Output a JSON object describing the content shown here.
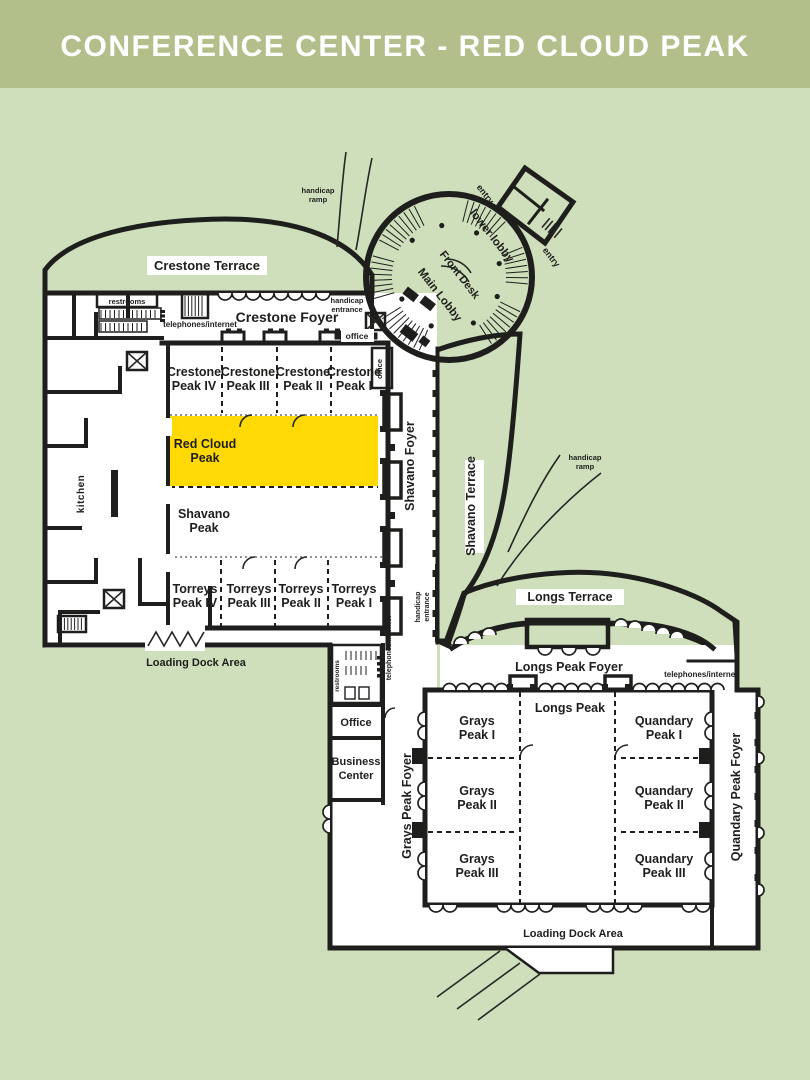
{
  "title": {
    "text": "CONFERENCE CENTER - RED CLOUD PEAK"
  },
  "colors": {
    "header_bg": "#b2bf8b",
    "page_bg": "#cfdfbc",
    "highlight": "#ffd903",
    "highlight_text": "#c7ae4e",
    "wall": "#1e1e1c",
    "terrace_fill": "#f3f2ec",
    "hatch_line": "#c2c2b8"
  },
  "lobby": {
    "lower_lobby": "lower lobby",
    "front_desk": "Front Desk",
    "main_lobby": "Main Lobby",
    "entry_upper": "entry",
    "entry_lower": "entry"
  },
  "terraces": {
    "crestone": "Crestone Terrace",
    "shavano": "Shavano Terrace",
    "longs": "Longs Terrace"
  },
  "foyers": {
    "crestone": "Crestone Foyer",
    "shavano": "Shavano Foyer",
    "longs_peak": "Longs Peak Foyer",
    "grays_peak": "Grays Peak Foyer",
    "quandary_peak": "Quandary Peak Foyer"
  },
  "rooms": {
    "crestone": [
      {
        "l1": "Crestone",
        "l2": "Peak IV"
      },
      {
        "l1": "Crestone",
        "l2": "Peak III"
      },
      {
        "l1": "Crestone",
        "l2": "Peak II"
      },
      {
        "l1": "Crestone",
        "l2": "Peak I"
      }
    ],
    "red_cloud": {
      "l1": "Red Cloud",
      "l2": "Peak"
    },
    "shavano": {
      "l1": "Shavano",
      "l2": "Peak"
    },
    "torreys": [
      {
        "l1": "Torreys",
        "l2": "Peak IV"
      },
      {
        "l1": "Torreys",
        "l2": "Peak III"
      },
      {
        "l1": "Torreys",
        "l2": "Peak II"
      },
      {
        "l1": "Torreys",
        "l2": "Peak I"
      }
    ],
    "longs": "Longs Peak",
    "grays": [
      {
        "l1": "Grays",
        "l2": "Peak I"
      },
      {
        "l1": "Grays",
        "l2": "Peak II"
      },
      {
        "l1": "Grays",
        "l2": "Peak III"
      }
    ],
    "quandary": [
      {
        "l1": "Quandary",
        "l2": "Peak I"
      },
      {
        "l1": "Quandary",
        "l2": "Peak II"
      },
      {
        "l1": "Quandary",
        "l2": "Peak III"
      }
    ]
  },
  "areas": {
    "kitchen": "kitchen",
    "office_small_top": "office",
    "office_small_side": "office",
    "office": "Office",
    "business_center": {
      "l1": "Business",
      "l2": "Center"
    },
    "loading_dock_left": "Loading Dock Area",
    "loading_dock_bottom": "Loading Dock Area"
  },
  "amenities": {
    "restrooms_top": "restrooms",
    "restrooms_mid": "restrooms",
    "telephones_top": "telephones/internet",
    "telephones_mid": "telephones/internet",
    "telephones_right": "telephones/internet",
    "handicap_ramp_top": {
      "l1": "handicap",
      "l2": "ramp"
    },
    "handicap_ramp_right": {
      "l1": "handicap",
      "l2": "ramp"
    },
    "handicap_entrance_top": {
      "l1": "handicap",
      "l2": "entrance"
    },
    "handicap_entrance_left": {
      "l1": "handicap",
      "l2": "entrance"
    }
  }
}
